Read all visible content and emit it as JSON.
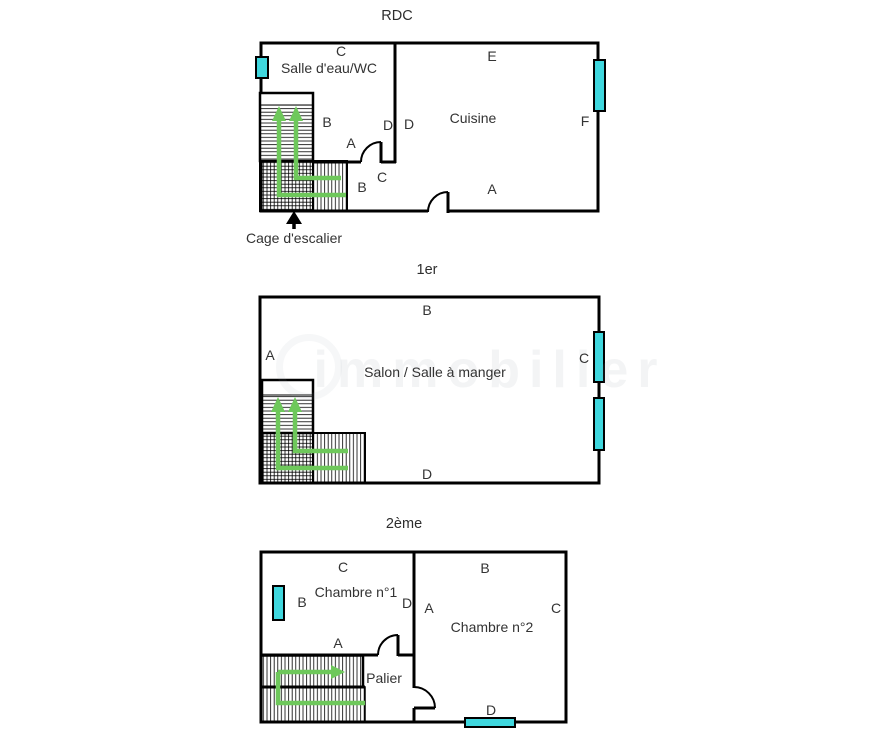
{
  "document_type": "floor-plans",
  "colors": {
    "wall": "#000000",
    "window": "#3fd7de",
    "stair_path": "#6ec85b",
    "text": "#333333"
  },
  "watermark": "immobilier",
  "floors": [
    {
      "title": "RDC",
      "rooms": {
        "salle_eau": "Salle d'eau/WC",
        "cuisine": "Cuisine"
      },
      "labels": {
        "c_top": "C",
        "e_top": "E",
        "b_stairs": "B",
        "a_mid": "A",
        "d_left": "D",
        "d_right": "D",
        "f_right": "F",
        "c_door": "C",
        "b_lower": "B",
        "a_bottom": "A"
      },
      "annotation": "Cage d'escalier"
    },
    {
      "title": "1er",
      "rooms": {
        "salon": "Salon / Salle à manger"
      },
      "labels": {
        "b_top": "B",
        "a_left": "A",
        "c_right": "C",
        "d_bottom": "D"
      }
    },
    {
      "title": "2ème",
      "rooms": {
        "chambre1": "Chambre n°1",
        "chambre2": "Chambre n°2",
        "palier": "Palier"
      },
      "labels": {
        "c1_c_top": "C",
        "c1_b": "B",
        "c1_d": "D",
        "c1_a_bottom": "A",
        "c2_a": "A",
        "c2_b_top": "B",
        "c2_c_right": "C",
        "d_bottom": "D"
      }
    }
  ]
}
